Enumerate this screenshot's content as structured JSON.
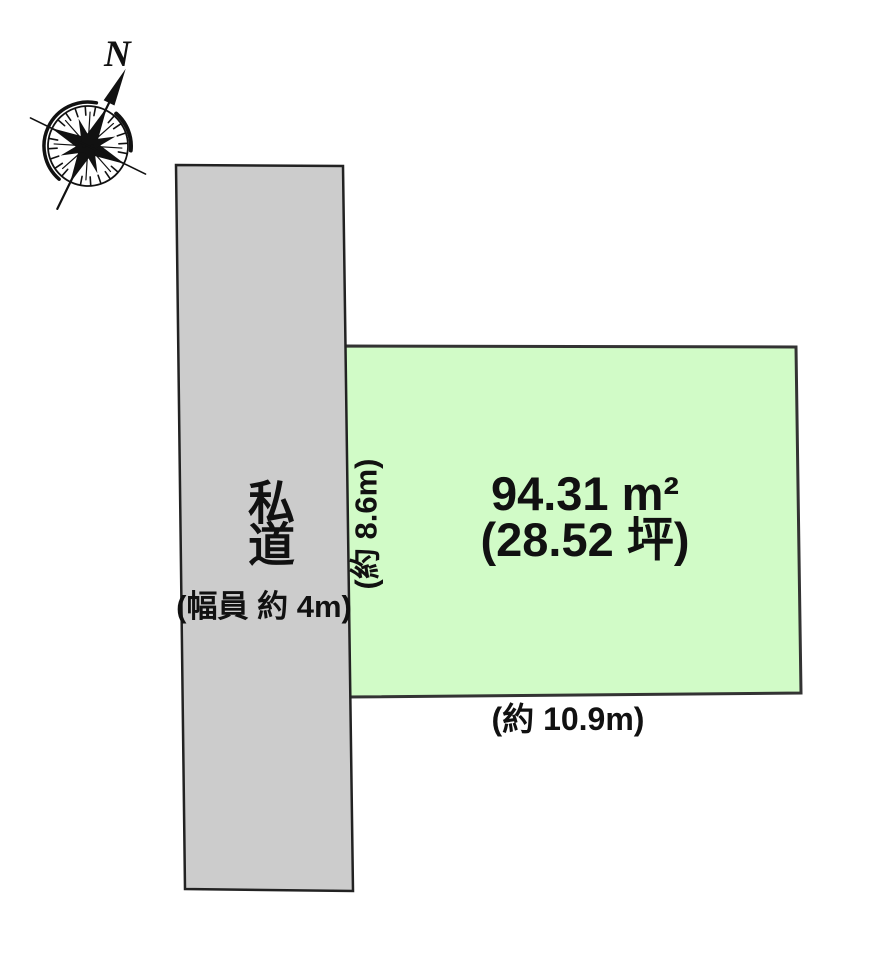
{
  "page": {
    "background": "#ffffff"
  },
  "compass": {
    "north_label": "N"
  },
  "road": {
    "label": "私道",
    "width_label": "(幅員 約 4m)",
    "fill": "#cccccc",
    "stroke": "#222222"
  },
  "parcel": {
    "area_label": "94.31 m²",
    "tsubo_label": "(28.52 坪)",
    "left_dimension_label": "(約 8.6m)",
    "bottom_dimension_label": "(約 10.9m)",
    "fill": "#d1fbc7",
    "stroke": "#333333"
  }
}
